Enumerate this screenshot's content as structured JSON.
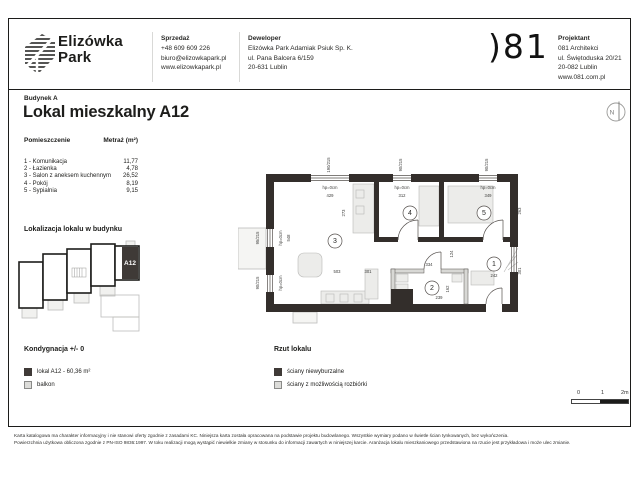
{
  "header": {
    "brand": {
      "line1": "Elizówka",
      "line2": "Park"
    },
    "sales": {
      "label": "Sprzedaż",
      "phone": "+48 609 609 226",
      "email": "biuro@elizowkapark.pl",
      "web": "www.elizowkapark.pl"
    },
    "developer": {
      "label": "Deweloper",
      "name": "Elizówka Park Adamiak Psiuk Sp. K.",
      "street": "ul. Pana Balcera 6/159",
      "city": "20-631 Lublin"
    },
    "logo081": ")81",
    "designer": {
      "label": "Projektant",
      "name": "081 Architekci",
      "street": "ul. Świętoduska 20/21",
      "city": "20-082 Lublin",
      "web": "www.081.com.pl"
    }
  },
  "section": {
    "building": "Budynek A",
    "unit": "Lokal mieszkalny A12"
  },
  "rooms": {
    "col_room": "Pomieszczenie",
    "col_area": "Metraż (m²)",
    "rows": [
      [
        "1 - Komunikacja",
        "11,77"
      ],
      [
        "2 - Łazienka",
        "4,78"
      ],
      [
        "3 - Salon z aneksem kuchennym",
        "26,52"
      ],
      [
        "4 - Pokój",
        "8,19"
      ],
      [
        "5 - Sypialnia",
        "9,15"
      ]
    ]
  },
  "location": {
    "heading": "Lokalizacja lokalu w budynku",
    "map_unit": "A12",
    "floor": "Kondygnacja +/- 0",
    "legend": [
      {
        "style": "dark",
        "label": "lokal A12 - 60,36 m²"
      },
      {
        "style": "light",
        "label": "balkon"
      }
    ]
  },
  "plan": {
    "heading": "Rzut lokalu",
    "legend": [
      {
        "style": "dark",
        "label": "ściany niewyburzalne"
      },
      {
        "style": "light",
        "label": "ściany z możliwością rozbiórki"
      }
    ],
    "compass": "N",
    "scale": [
      "0",
      "1",
      "2m"
    ],
    "rooms": [
      {
        "n": "1",
        "x": 256,
        "y": 108
      },
      {
        "n": "2",
        "x": 194,
        "y": 132
      },
      {
        "n": "3",
        "x": 97,
        "y": 85
      },
      {
        "n": "4",
        "x": 172,
        "y": 57
      },
      {
        "n": "5",
        "x": 246,
        "y": 57
      }
    ],
    "labels": [
      {
        "t": "190/215",
        "x": 92,
        "y": 9,
        "r": 1
      },
      {
        "t": "90/215",
        "x": 164,
        "y": 9,
        "r": 1
      },
      {
        "t": "90/215",
        "x": 250,
        "y": 9,
        "r": 1
      },
      {
        "t": "hp=0cm",
        "x": 92,
        "y": 33
      },
      {
        "t": "429",
        "x": 92,
        "y": 41
      },
      {
        "t": "hp=0cm",
        "x": 164,
        "y": 33
      },
      {
        "t": "312",
        "x": 164,
        "y": 41
      },
      {
        "t": "hp=0cm",
        "x": 250,
        "y": 33
      },
      {
        "t": "349",
        "x": 250,
        "y": 41
      },
      {
        "t": "95/215",
        "x": 21,
        "y": 82,
        "r": 1
      },
      {
        "t": "hp=0cm",
        "x": 44,
        "y": 82,
        "r": 1
      },
      {
        "t": "548",
        "x": 52,
        "y": 82,
        "r": 1
      },
      {
        "t": "90/215",
        "x": 21,
        "y": 127,
        "r": 1
      },
      {
        "t": "hp=0cm",
        "x": 44,
        "y": 127,
        "r": 1
      },
      {
        "t": "273",
        "x": 107,
        "y": 57,
        "r": 1
      },
      {
        "t": "503",
        "x": 99,
        "y": 117
      },
      {
        "t": "301",
        "x": 130,
        "y": 117
      },
      {
        "t": "334",
        "x": 191,
        "y": 110
      },
      {
        "t": "242",
        "x": 256,
        "y": 121
      },
      {
        "t": "301",
        "x": 283,
        "y": 115,
        "r": 1
      },
      {
        "t": "263",
        "x": 283,
        "y": 55,
        "r": 1
      },
      {
        "t": "124",
        "x": 215,
        "y": 98,
        "r": 1
      },
      {
        "t": "239",
        "x": 201,
        "y": 143
      },
      {
        "t": "162",
        "x": 211,
        "y": 133,
        "r": 1
      }
    ]
  },
  "footer": {
    "line1": "Karta katalogowa ma charakter informacyjny i nie stanowi oferty zgodnie z zasadami KC. Niniejsza karta została opracowana na podstawie projektu budowlanego. Wszystkie wymiary podano w świetle ścian tynkowanych, bez wykończenia.",
    "line2": "Powierzchnia użytkowa obliczona zgodnie z PN-ISO 9836:1997. W toku realizacji mogą wystąpić niewielkie zmiany w stosunku do informacji zawartych w niniejszej karcie. Aranżacja lokalu mieszkaniowego przedstawiona na rzucie jest przykładowa i może ulec zmianie."
  },
  "colors": {
    "ink": "#1d1d1b",
    "wall": "#332e2b",
    "light_wall": "#d8d8d5",
    "swatch_dark": "#3f3a37",
    "swatch_light": "#dcdcd9"
  }
}
